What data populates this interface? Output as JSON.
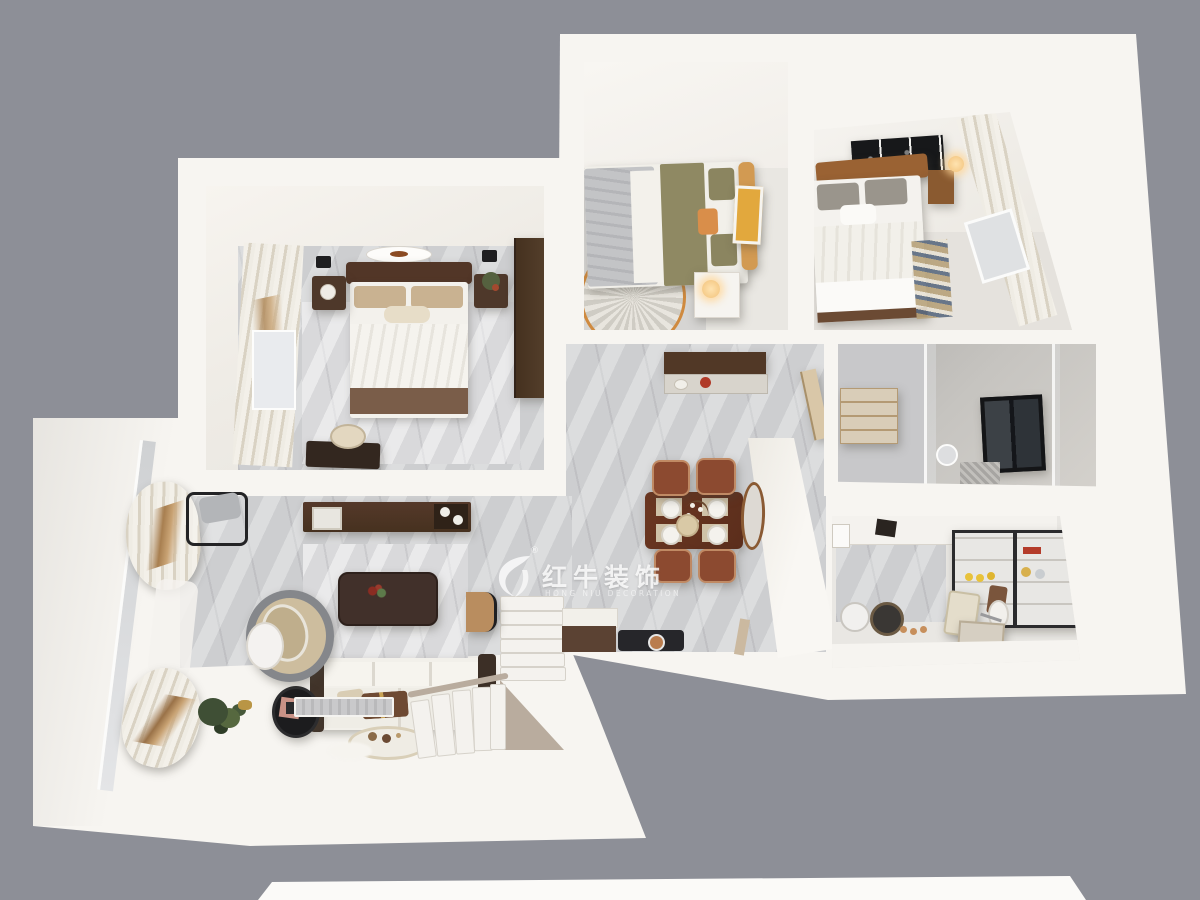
{
  "watermark": {
    "brand": "红牛装饰",
    "registered": "®",
    "subtext": "HONG NIU DECORATION",
    "logo": "bull-swoosh-logo"
  },
  "scene": {
    "type": "3d-floor-plan-top-down-render",
    "rooms": [
      "master-bedroom",
      "bedroom-2",
      "bedroom-3",
      "living-room",
      "dining-area",
      "kitchen",
      "bathroom",
      "balcony",
      "entry-hall",
      "staircase"
    ]
  },
  "palette": {
    "background_gray": "#8d8f97",
    "wall_white": "#f7f5f1",
    "floor_marble": "#cdced0",
    "wood_dark": "#4b3425",
    "wood_red": "#5d2f1d",
    "chair_brown": "#8c4a30",
    "headboard_orange": "#d29a52",
    "art_yellow": "#e2a83d",
    "olive_blanket": "#8f8963",
    "taupe_stair": "#b9ac9e",
    "black_frame": "#1d1d1f"
  }
}
